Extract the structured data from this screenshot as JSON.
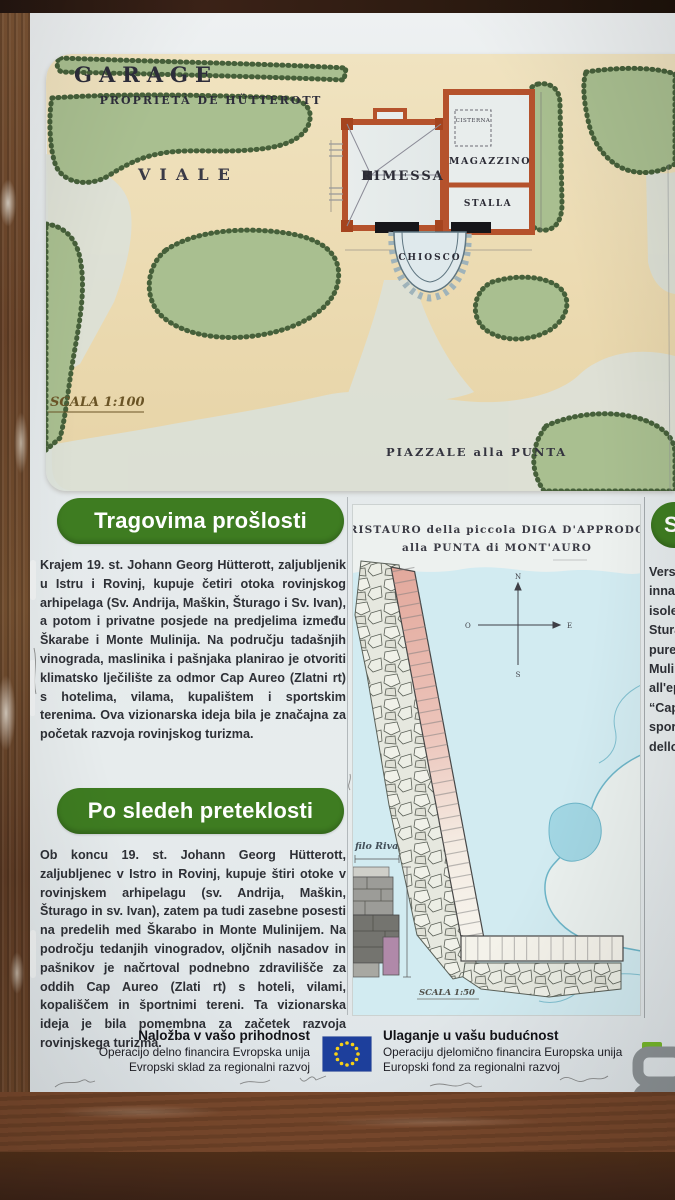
{
  "top_map": {
    "title": "GARAGE",
    "subtitle": "PROPRIETÀ DE HÜTTEROTT",
    "viale": "VIALE",
    "rimessa": "RIMESSA",
    "magazzino": "MAGAZZINO",
    "cisterna": "CISTERNA",
    "stalla": "STALLA",
    "chiosco": "CHIOSCO",
    "scale": "SCALA 1:100",
    "piazzale": "PIAZZALE alla PUNTA"
  },
  "sections": [
    {
      "heading": "Tragovima prošlosti",
      "body": "Krajem 19. st. Johann Georg Hütterott, zaljubljenik u Istru i Rovinj, kupuje četiri otoka rovinjskog arhipelaga (Sv. Andrija, Maškin, Šturago i Sv. Ivan), a potom i privatne posjede na predjelima između Škarabe i Monte Mulinija. Na području tadašnjih vinograda, maslinika i pašnjaka planirao je otvoriti klimatsko lječilište za odmor Cap Aureo (Zlatni rt) s hotelima, vilama, kupalištem i sportskim terenima. Ova vizionarska ideja bila je značajna za početak razvoja rovinjskog turizma."
    },
    {
      "heading": "Po sledeh preteklosti",
      "body": "Ob koncu 19. st. Johann Georg Hütterott, zaljubljenec v Istro in Rovinj, kupuje štiri otoke v rovinjskem arhipelagu (sv. Andrija, Maškin, Šturago in sv. Ivan), zatem pa tudi zasebne posesti na predelih med Škarabo in Monte Mulinijem. Na področju tedanjih vinogradov, oljčnih nasadov in pašnikov je načrtoval podnebno zdravilišče za oddih Cap Aureo (Zlati rt) s hoteli, vilami, kopališčem in športnimi tereni. Ta vizionarska ideja je bila pomembna za začetek razvoja rovinjskega turizma."
    }
  ],
  "pier_map": {
    "title1": "RISTAURO della piccola DIGA D'APPRODO",
    "title2": "alla PUNTA di MONT'AURO",
    "filo_riva": "filo Riva",
    "scale": "SCALA 1:50",
    "compass": {
      "n": "N",
      "s": "S",
      "e": "E",
      "o": "O"
    }
  },
  "side_column": {
    "heading_fragment": "S",
    "fragments": [
      "Vers",
      "inna",
      "isole",
      "Stura",
      "pure",
      "Mulin",
      "all'ep",
      "“Cap",
      "sporti",
      "dello s"
    ]
  },
  "footer": {
    "sl_title": "Naložba v vašo prihodnost",
    "sl_line2": "Operacijo delno financira Evropska unija",
    "sl_line3": "Evropski sklad za regionalni razvoj",
    "hr_title": "Ulaganje u vašu budućnost",
    "hr_line2": "Operaciju djelomično financira Europska unija",
    "hr_line3": "Europski fond za regionalni razvoj"
  },
  "colors": {
    "accent_green": "#3e7c21",
    "eu_blue": "#1d3f9c",
    "eu_star_yellow": "#f7d117",
    "wood_brown": "#6a4429",
    "map_cream": "#ecdbb2"
  }
}
